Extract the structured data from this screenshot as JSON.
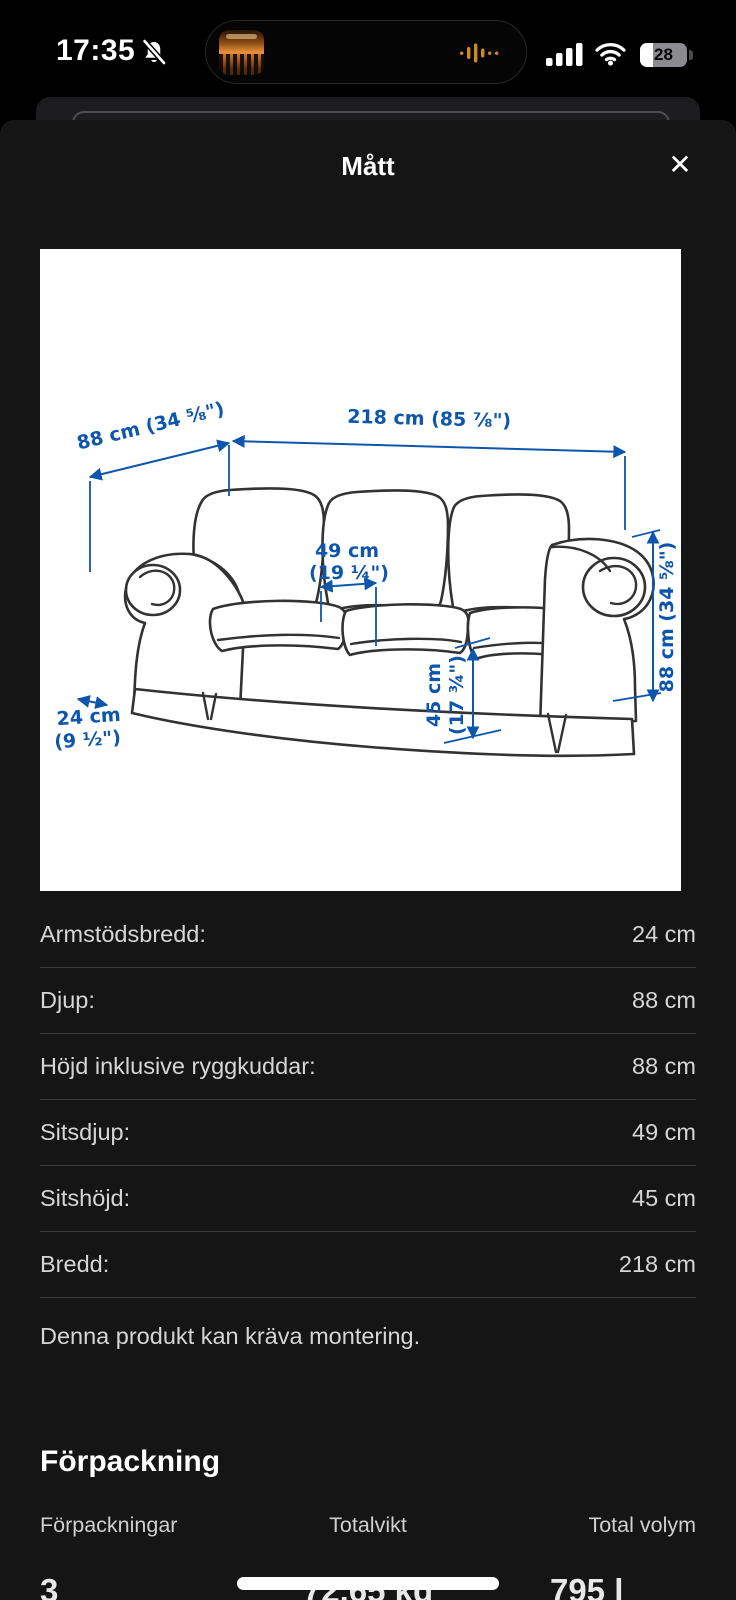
{
  "status_bar": {
    "time": "17:35",
    "battery_percent": "28"
  },
  "modal": {
    "title": "Mått",
    "close_icon": "✕"
  },
  "diagram": {
    "labels": {
      "depth": "88 cm (34 ⅝\")",
      "width": "218 cm (85 ⅞\")",
      "height": "88 cm (34 ⅝\")",
      "seat_depth_cm": "49 cm",
      "seat_depth_in": "(19 ¼\")",
      "seat_height_cm": "45 cm",
      "seat_height_in": "(17 ¾\")",
      "arm_width_cm": "24 cm",
      "arm_width_in": "(9 ½\")"
    }
  },
  "measurements": {
    "rows": [
      {
        "label": "Armstödsbredd:",
        "value": "24 cm"
      },
      {
        "label": "Djup:",
        "value": "88 cm"
      },
      {
        "label": "Höjd inklusive ryggkuddar:",
        "value": "88 cm"
      },
      {
        "label": "Sitsdjup:",
        "value": "49 cm"
      },
      {
        "label": "Sitshöjd:",
        "value": "45 cm"
      },
      {
        "label": "Bredd:",
        "value": "218 cm"
      }
    ]
  },
  "assembly_note": "Denna produkt kan kräva montering.",
  "packaging": {
    "heading": "Förpackning",
    "columns": [
      {
        "label": "Förpackningar",
        "value": "3"
      },
      {
        "label": "Totalvikt",
        "value": "72.65 kg"
      },
      {
        "label": "Total volym",
        "value": "795 l"
      }
    ]
  }
}
